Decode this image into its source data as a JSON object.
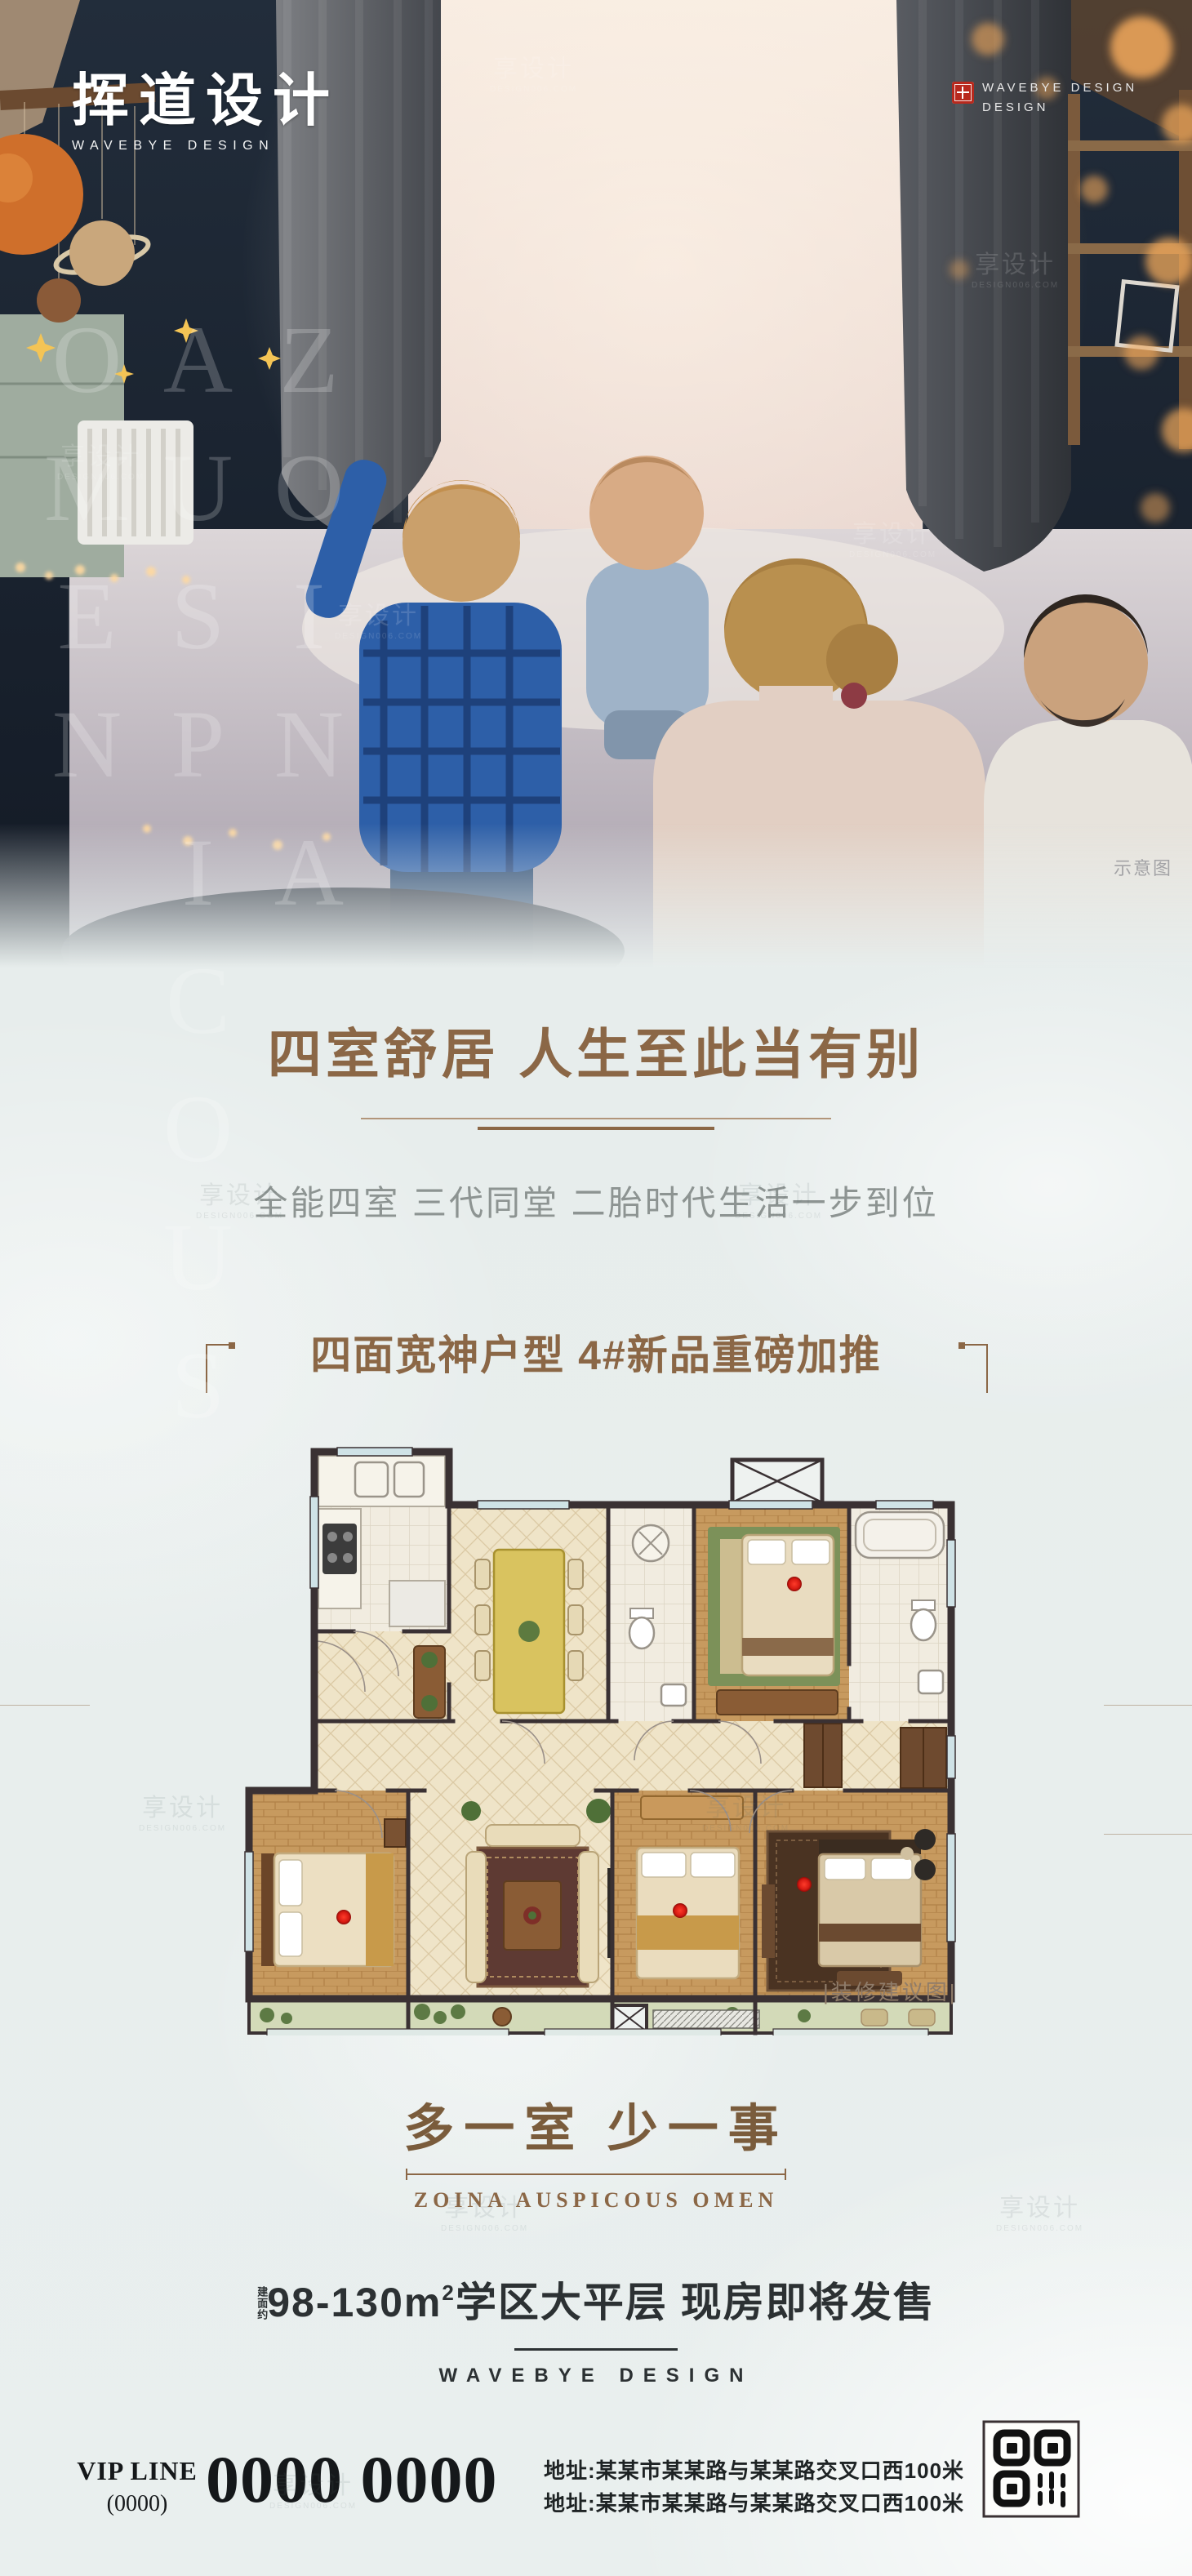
{
  "brand": {
    "logo_cn": "挥道设计",
    "logo_en": "WAVEBYE DESIGN",
    "topright_line1": "WAVEBYE DESIGN",
    "topright_line2": "DESIGN"
  },
  "photo": {
    "caption": "示意图"
  },
  "watermarks": {
    "vertical": "ZOINA AUSPICOUS OMEN",
    "tile_cn": "享设计",
    "tile_en": "DESIGN006.COM"
  },
  "hero": {
    "title": "四室舒居 人生至此当有别",
    "subtitle": "全能四室 三代同堂 二胎时代生活一步到位"
  },
  "plan": {
    "title": "四面宽神户型 4#新品重磅加推",
    "caption": "|装修建议图|"
  },
  "slogan": {
    "cn": "多一室 少一事",
    "en": "ZOINA AUSPICOUS OMEN"
  },
  "offer": {
    "area_prefix": "建面约",
    "area_main": "98-130m",
    "area_sup": "2",
    "area_tail": "学区大平层 现房即将发售",
    "brand": "WAVEBYE DESIGN"
  },
  "footer": {
    "vip_label": "VIP LINE",
    "vip_paren": "(0000)",
    "phone": "0000 0000",
    "address1": "地址:某某市某某路与某某路交叉口西100米",
    "address2": "地址:某某市某某路与某某路交叉口西100米"
  },
  "colors": {
    "accent_brown": "#8b6746",
    "dark_text": "#2c3133",
    "subtitle_gray": "#8d9492",
    "seal_red": "#b8291d",
    "bg_light": "#e7edec",
    "red_dot": "#d61a12"
  }
}
